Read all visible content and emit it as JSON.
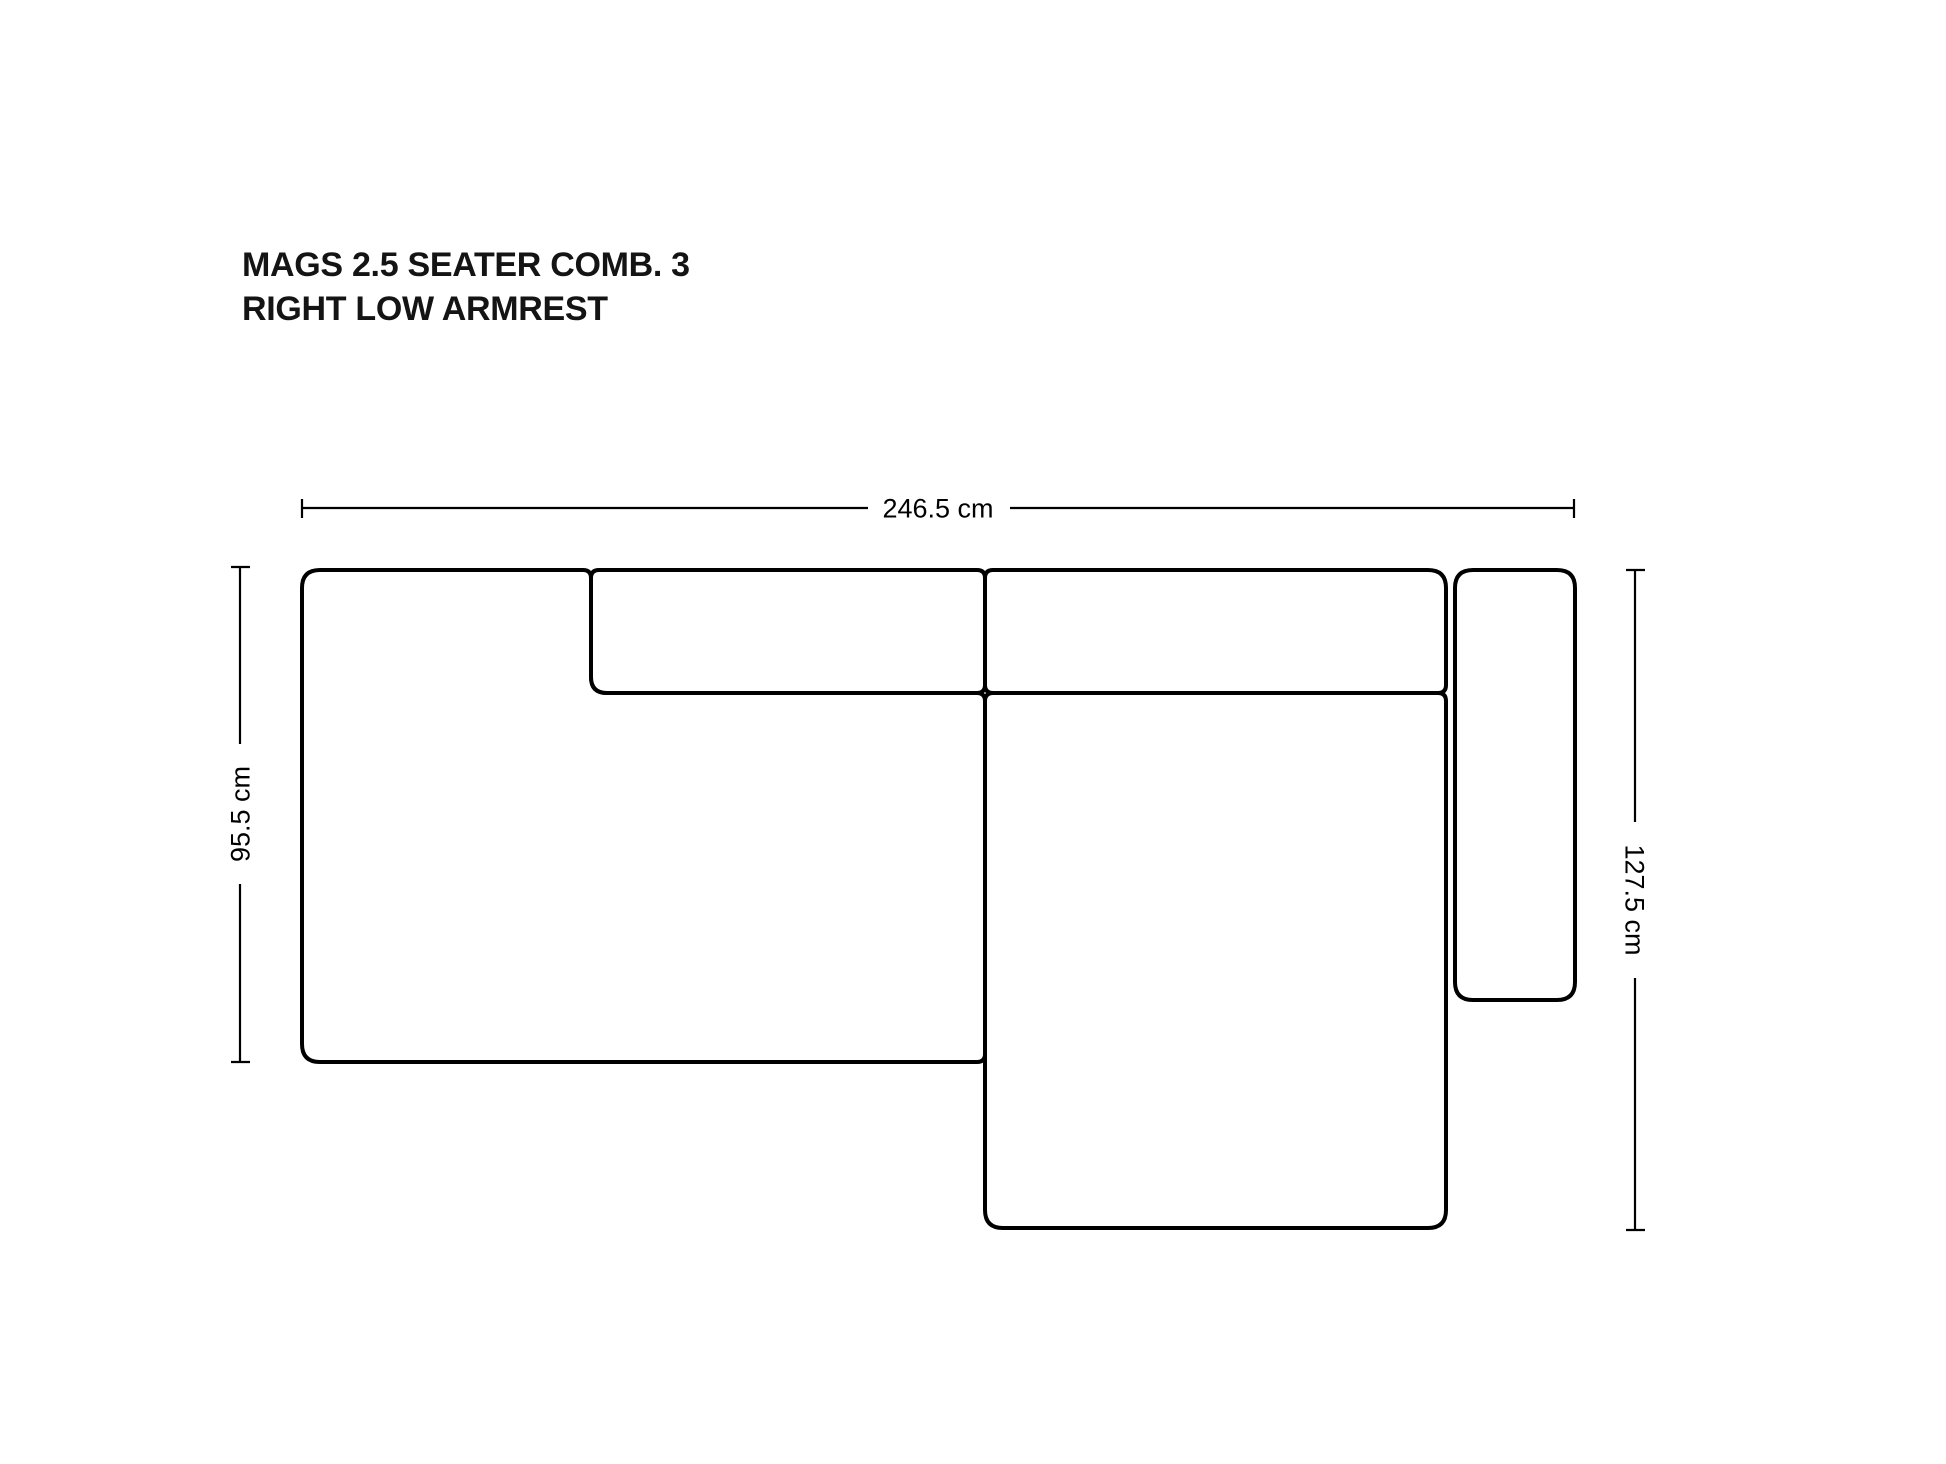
{
  "title": {
    "line1": "MAGS 2.5 SEATER COMB. 3",
    "line2": "RIGHT LOW ARMREST"
  },
  "dimensions": {
    "total_width": {
      "label": "246.5 cm",
      "position": "top"
    },
    "left_depth": {
      "label": "95.5 cm",
      "position": "left"
    },
    "right_depth": {
      "label": "127.5 cm",
      "position": "right"
    }
  },
  "colors": {
    "background": "#ffffff",
    "outline": "#000000",
    "title_text": "#141414"
  }
}
